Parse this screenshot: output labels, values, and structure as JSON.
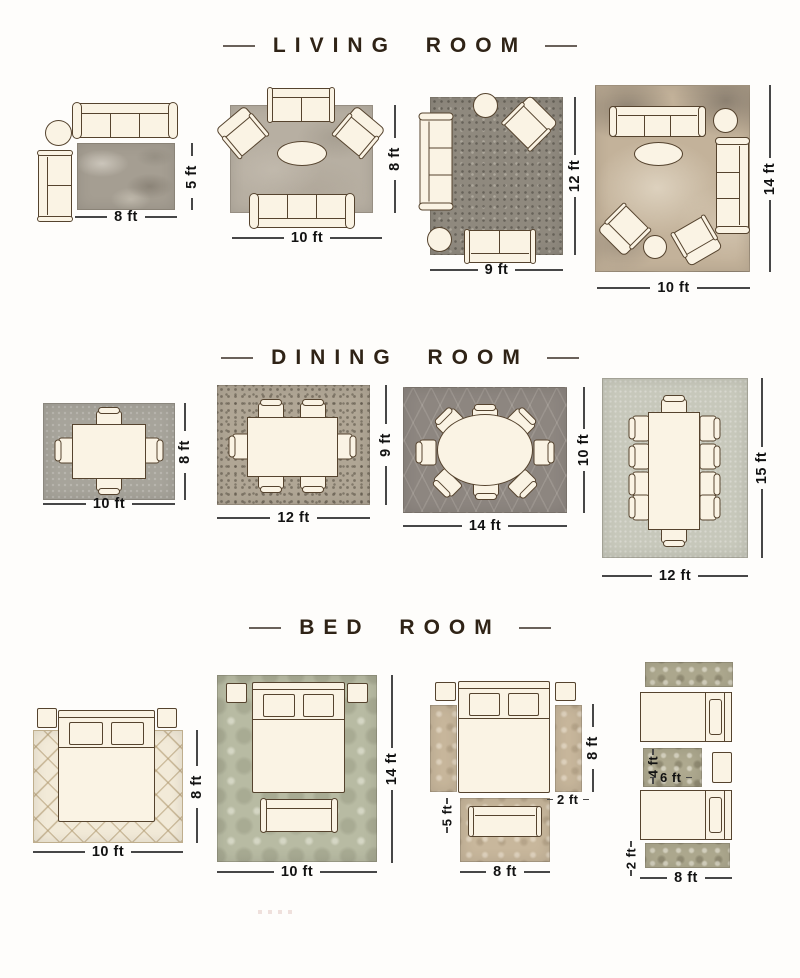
{
  "palette": {
    "background": "#fefdfb",
    "title_text": "#2f2316",
    "title_dash": "#6a615a",
    "dimension_text": "#121212",
    "dimension_line": "#474747",
    "furniture_fill": "#faf3e4",
    "furniture_outline": "#55432e",
    "rug_colors": {
      "living": [
        "#a59e92",
        "#b7afa2",
        "#8f897e",
        "#c3b29a"
      ],
      "dining": [
        "#a7a49b",
        "#b0a695",
        "#8d8680",
        "#c7c8bb"
      ],
      "bedroom": [
        "#f2ead8",
        "#b8bba3",
        "#c8b79c",
        "#aea98f"
      ]
    }
  },
  "sections": [
    {
      "title": "LIVING ROOM",
      "layouts": [
        {
          "bottom": "8 ft",
          "side": "5 ft"
        },
        {
          "bottom": "10 ft",
          "side": "8 ft"
        },
        {
          "bottom": "9 ft",
          "side": "12 ft"
        },
        {
          "bottom": "10 ft",
          "side": "14 ft"
        }
      ]
    },
    {
      "title": "DINING ROOM",
      "layouts": [
        {
          "bottom": "10 ft",
          "side": "8 ft"
        },
        {
          "bottom": "12 ft",
          "side": "9 ft"
        },
        {
          "bottom": "14 ft",
          "side": "10 ft"
        },
        {
          "bottom": "12 ft",
          "side": "15 ft"
        }
      ]
    },
    {
      "title": "BED ROOM",
      "layouts": [
        {
          "bottom": "10 ft",
          "side": "8 ft"
        },
        {
          "bottom": "10 ft",
          "side": "14 ft"
        },
        {
          "bottom": "8 ft",
          "side": "8 ft",
          "runner_width": "2 ft",
          "foot_rug_height": "5 ft"
        },
        {
          "bottom": "8 ft",
          "runner_height": "2 ft",
          "accent_rug_width": "6 ft",
          "accent_rug_height": "4 ft"
        }
      ]
    }
  ]
}
